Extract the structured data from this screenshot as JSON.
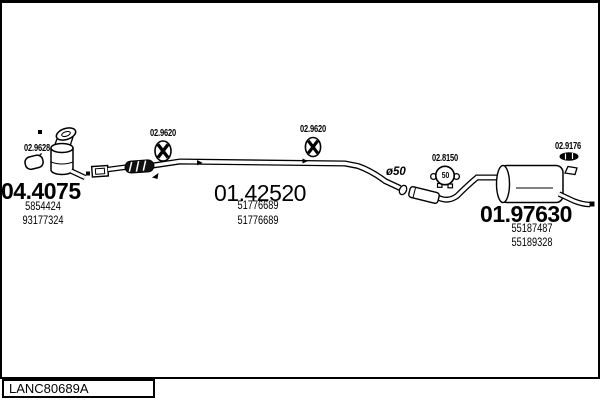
{
  "footer": {
    "code": "LANC80689A"
  },
  "annotations": {
    "gasket": {
      "label": "02.9628"
    },
    "hanger_front": {
      "label": "02.9620"
    },
    "hanger_mid": {
      "label": "02.9620"
    },
    "clamp": {
      "label": "02.8150",
      "size": "50"
    },
    "mount_rear": {
      "label": "02.9176"
    },
    "pipe_diameter": "ø50"
  },
  "assemblies": {
    "front_catalyst": {
      "code": "04.4075",
      "refs": [
        "5854424",
        "93177324"
      ]
    },
    "centre_pipe": {
      "code": "01.42520",
      "refs": [
        "51776689",
        "51776689"
      ]
    },
    "rear_silencer": {
      "code": "01.97630",
      "refs": [
        "55187487",
        "55189328"
      ]
    }
  },
  "colors": {
    "line": "#000000",
    "background": "#ffffff"
  }
}
